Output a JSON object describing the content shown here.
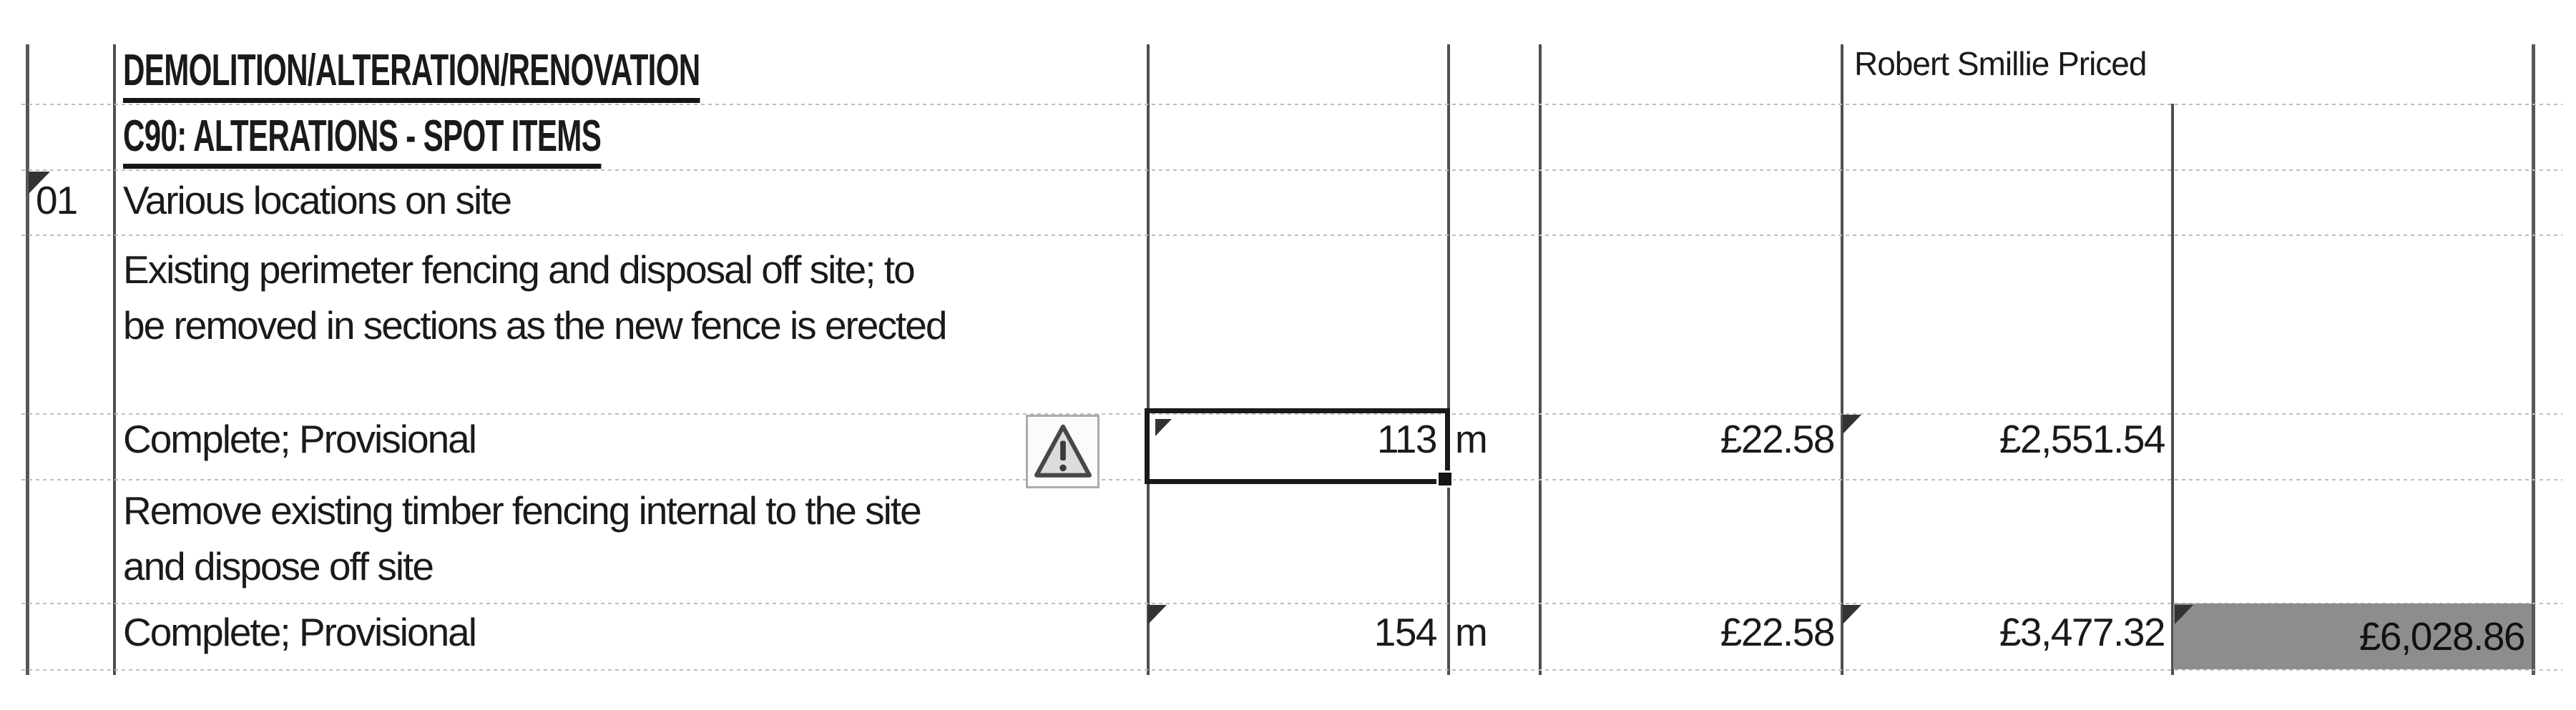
{
  "sheet": {
    "section_heading": "DEMOLITION/ALTERATION/RENOVATION",
    "subsection_heading": "C90: ALTERATIONS - SPOT ITEMS",
    "priced_note": "Robert Smillie Priced",
    "item_number": "01",
    "item_location": "Various locations on site"
  },
  "entries": [
    {
      "description_line1": "Existing perimeter fencing and disposal off site; to",
      "description_line2": "be removed in sections as the new fence is erected",
      "status": "Complete; Provisional",
      "quantity": "113",
      "unit": "m",
      "rate": "£22.58",
      "amount": "£2,551.54"
    },
    {
      "description_line1": "Remove existing timber fencing internal to the site",
      "description_line2": "and dispose off site",
      "status": "Complete; Provisional",
      "quantity": "154",
      "unit": "m",
      "rate": "£22.58",
      "amount": "£3,477.32",
      "section_total": "£6,028.86"
    }
  ],
  "colors": {
    "text": "#1a1a1a",
    "vertical_gridline": "#4f4f4f",
    "horizontal_gridline": "#bdbdbd",
    "selection_border": "#1a1a1a",
    "highlight_cell_fill": "#8d8d8d",
    "indicator_triangle": "#333333",
    "warning_icon_border": "#ababab"
  },
  "icons": {
    "warning": "warning-triangle-icon",
    "cell_indicator": "cell-error-indicator",
    "fill_handle": "selection-fill-handle"
  }
}
